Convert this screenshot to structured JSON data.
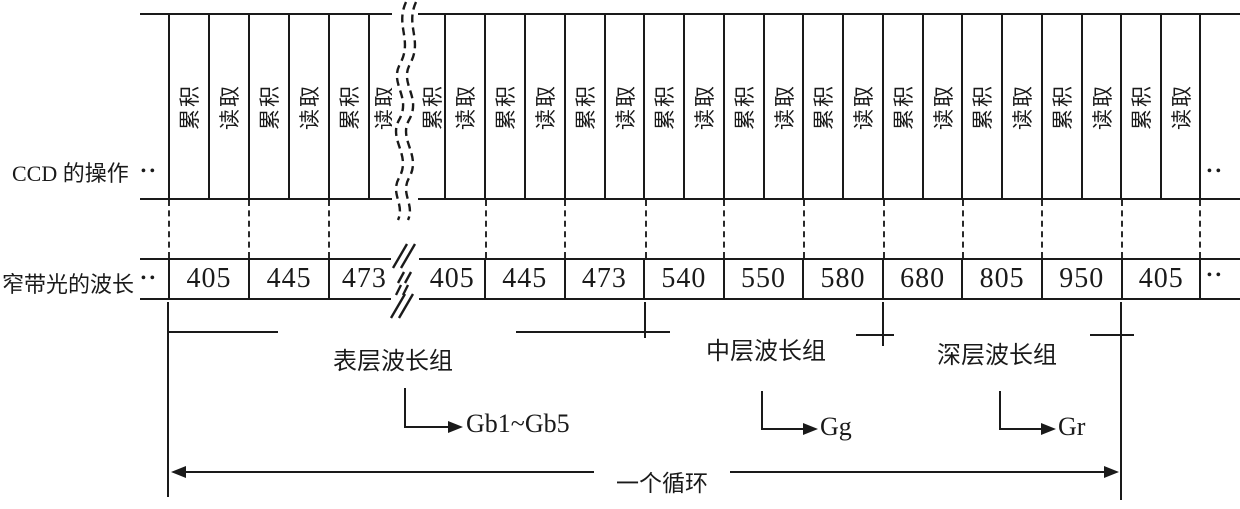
{
  "figure": {
    "ccd_row": {
      "label": "CCD 的操作",
      "left_dots": "••",
      "right_dots": "••",
      "cells_before_break": [
        "累积",
        "读取",
        "累积",
        "读取",
        "累积",
        "读取"
      ],
      "cells_after_break": [
        "累积",
        "读取",
        "累积",
        "读取",
        "累积",
        "读取",
        "累积",
        "读取",
        "累积",
        "读取",
        "累积",
        "读取",
        "累积",
        "读取",
        "累积",
        "读取",
        "累积",
        "读取",
        "累积",
        "读取"
      ]
    },
    "wavelength_row": {
      "label": "窄带光的波长",
      "left_dots": "••",
      "right_dots": "••",
      "values_before_break": [
        "405",
        "445",
        "473"
      ],
      "values_after_break": [
        "405",
        "445",
        "473",
        "540",
        "550",
        "580",
        "680",
        "805",
        "950",
        "405"
      ]
    },
    "wavelength_groups": [
      {
        "label": "表层波长组",
        "signal": "Gb1~Gb5"
      },
      {
        "label": "中层波长组",
        "signal": "Gg"
      },
      {
        "label": "深层波长组",
        "signal": "Gr"
      }
    ],
    "cycle_label": "一个循环",
    "colors": {
      "line": "#1a1a1a",
      "background": "#ffffff"
    }
  }
}
